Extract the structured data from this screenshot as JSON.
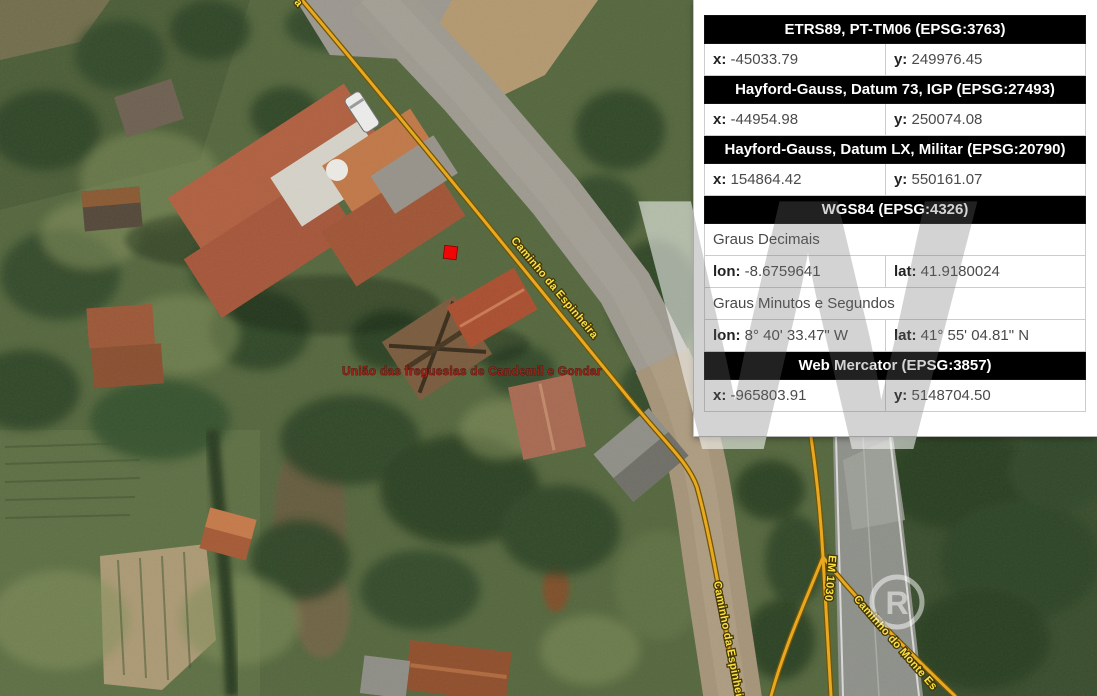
{
  "theme": {
    "road-line": "#eaa81c",
    "road-line-outline": "#6e5200",
    "street-label": "#ffe23e",
    "street-label-outline": "#403400",
    "admin-label": "#962015",
    "marker": "#f20000",
    "panel-bg": "#ffffff",
    "panel-border": "#cccccc",
    "header-bg": "#000000",
    "header-text": "#ffffff",
    "cell-text": "#4a4a4a",
    "cell-label": "#222222"
  },
  "map": {
    "admin_area_label": "União das freguesias de Candemil e Gondar",
    "street_labels": {
      "espinheira_main": "Caminho da Espinheira",
      "espinheira_south": "Caminho da Espinheira",
      "em1030": "EM 1030",
      "monte": "Caminho do Monte Es",
      "top_fragment": "a"
    }
  },
  "watermark": {
    "letter": "W",
    "badge_letter": "R"
  },
  "panel": {
    "rows": [
      {
        "type": "header",
        "text": "ETRS89, PT-TM06 (EPSG:3763)"
      },
      {
        "type": "pair",
        "cells": [
          {
            "label": "x:",
            "value": "-45033.79"
          },
          {
            "label": "y:",
            "value": "249976.45"
          }
        ]
      },
      {
        "type": "header",
        "text": "Hayford-Gauss, Datum 73, IGP (EPSG:27493)"
      },
      {
        "type": "pair",
        "cells": [
          {
            "label": "x:",
            "value": "-44954.98"
          },
          {
            "label": "y:",
            "value": "250074.08"
          }
        ]
      },
      {
        "type": "header",
        "text": "Hayford-Gauss, Datum LX, Militar (EPSG:20790)"
      },
      {
        "type": "pair",
        "cells": [
          {
            "label": "x:",
            "value": "154864.42"
          },
          {
            "label": "y:",
            "value": "550161.07"
          }
        ]
      },
      {
        "type": "header",
        "text": "WGS84 (EPSG:4326)"
      },
      {
        "type": "sub",
        "text": "Graus Decimais"
      },
      {
        "type": "pair",
        "cells": [
          {
            "label": "lon:",
            "value": "-8.6759641"
          },
          {
            "label": "lat:",
            "value": "41.9180024"
          }
        ]
      },
      {
        "type": "sub",
        "text": "Graus Minutos e Segundos"
      },
      {
        "type": "pair",
        "cells": [
          {
            "label": "lon:",
            "value": "8° 40' 33.47\" W"
          },
          {
            "label": "lat:",
            "value": "41° 55' 04.81\" N"
          }
        ]
      },
      {
        "type": "header",
        "text": "Web Mercator (EPSG:3857)"
      },
      {
        "type": "pair",
        "cells": [
          {
            "label": "x:",
            "value": "-965803.91"
          },
          {
            "label": "y:",
            "value": "5148704.50"
          }
        ]
      }
    ]
  }
}
